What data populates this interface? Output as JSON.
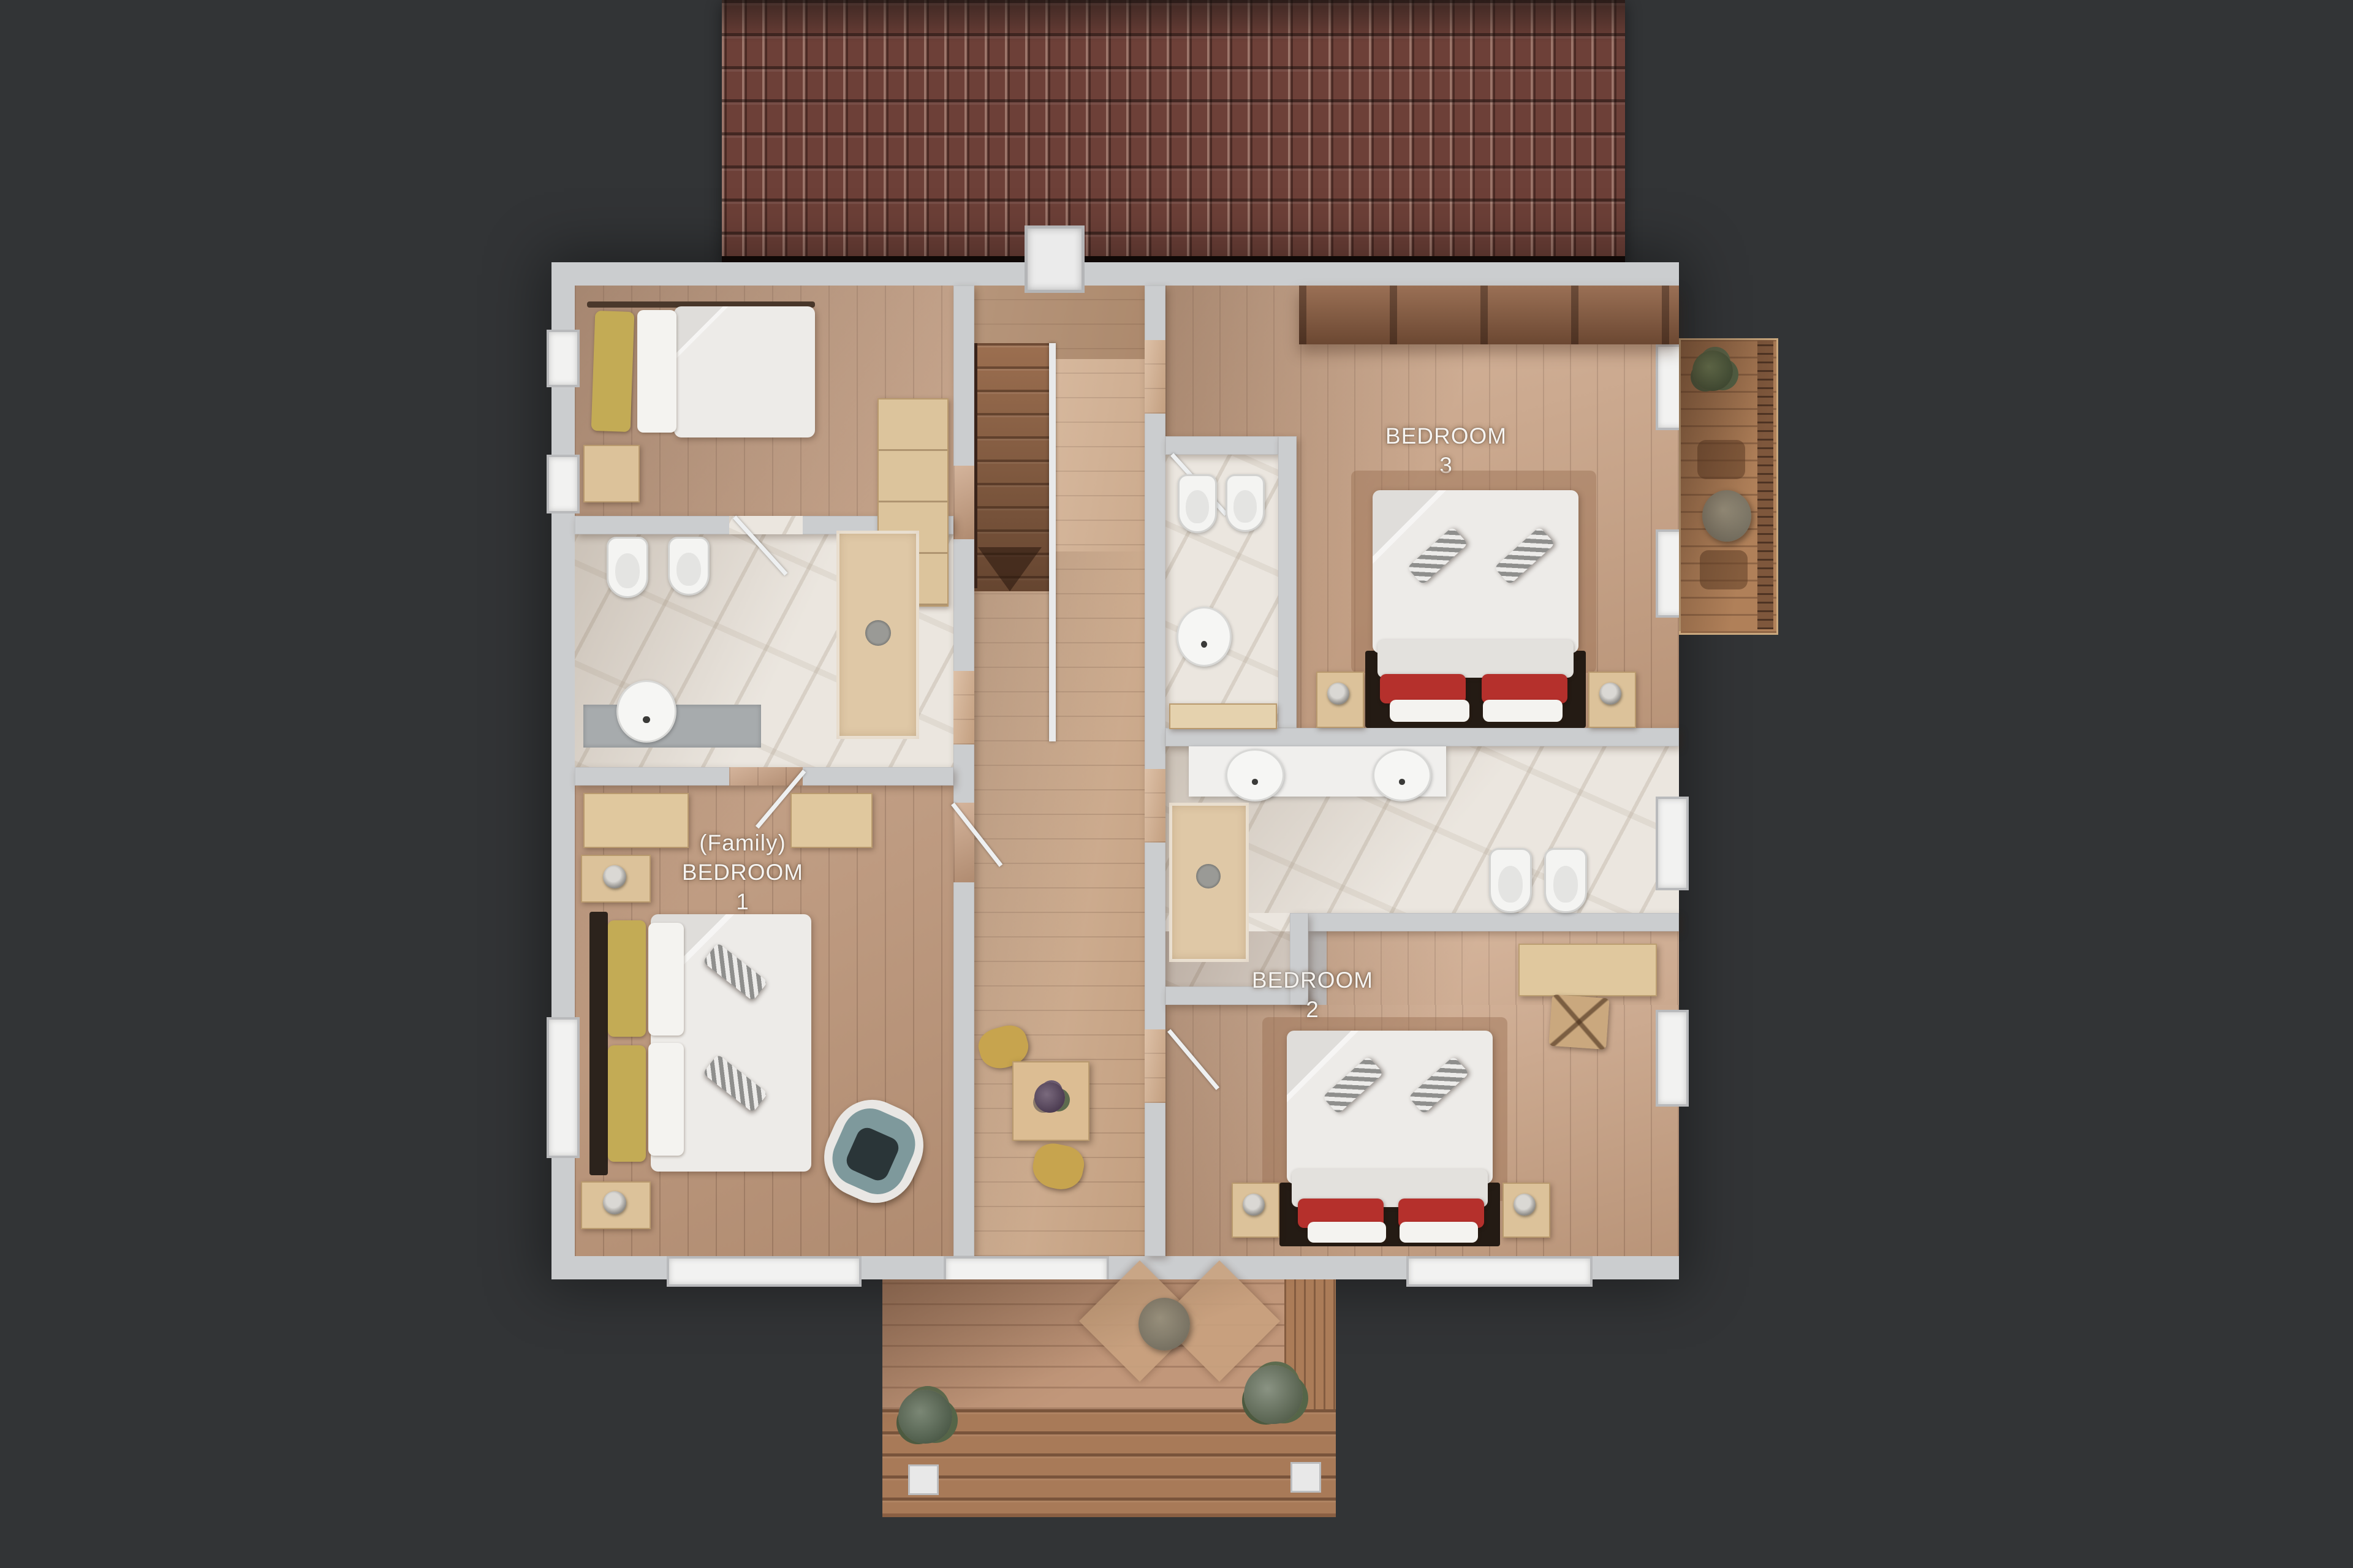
{
  "labels": {
    "bedroom3": {
      "line1": "BEDROOM",
      "line2": "3"
    },
    "family_bedroom1": {
      "line1": "(Family)",
      "line2": "BEDROOM",
      "line3": "1"
    },
    "bedroom2": {
      "line1": "BEDROOM",
      "line2": "2"
    }
  },
  "palette": {
    "background": "#323436",
    "wall": "#cbcdcf",
    "roof_tile": "#6d4038",
    "hallway_floor": "#cfa988",
    "bedroom_floor": "#c49b7d",
    "balcony_deck": "#b08059",
    "terrace_deck": "#c1977a",
    "marble": "#ebe6df",
    "duvet": "#edebe8",
    "pillow_yellow": "#c3ab55",
    "pillow_red": "#b5302c",
    "armchair_teal": "#7e999c",
    "chair_yellow": "#c7a44e",
    "plant_green": "#5d6f4c",
    "label_text": "#f6f4f1"
  }
}
